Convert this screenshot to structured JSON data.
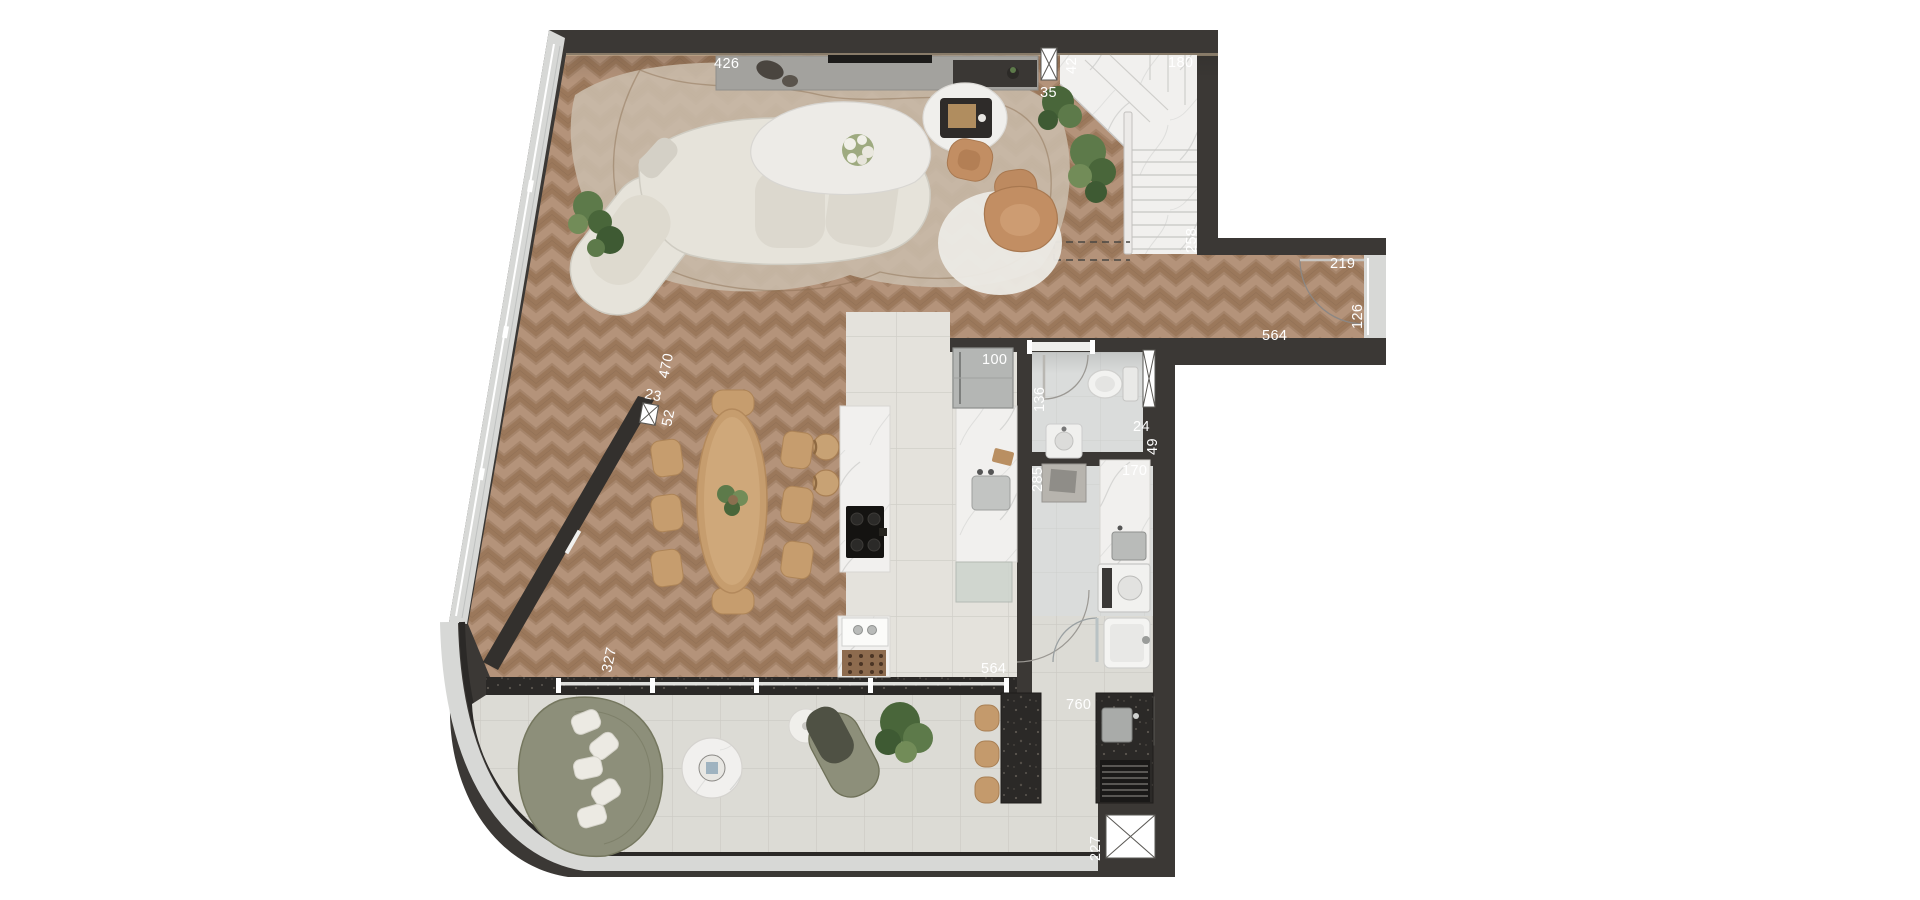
{
  "plan": {
    "type": "apartment-floor-plan-top-view",
    "labels": [
      {
        "id": "living-north-wall",
        "text": "426",
        "orientation": "horizontal"
      },
      {
        "id": "stair-door-gap",
        "text": "35",
        "orientation": "horizontal"
      },
      {
        "id": "stair-window",
        "text": "42",
        "orientation": "vertical"
      },
      {
        "id": "stair-width",
        "text": "180",
        "orientation": "horizontal"
      },
      {
        "id": "stair-depth",
        "text": "258",
        "orientation": "vertical"
      },
      {
        "id": "hallway-width",
        "text": "219",
        "orientation": "horizontal"
      },
      {
        "id": "hallway-door",
        "text": "126",
        "orientation": "vertical"
      },
      {
        "id": "hallway-length",
        "text": "564",
        "orientation": "horizontal"
      },
      {
        "id": "west-window",
        "text": "470",
        "orientation": "vertical"
      },
      {
        "id": "west-pier",
        "text": "23",
        "orientation": "horizontal"
      },
      {
        "id": "west-small-window",
        "text": "52",
        "orientation": "vertical"
      },
      {
        "id": "kitchen-counter-width",
        "text": "100",
        "orientation": "horizontal"
      },
      {
        "id": "bathroom-depth",
        "text": "136",
        "orientation": "vertical"
      },
      {
        "id": "bathroom-pier",
        "text": "24",
        "orientation": "horizontal"
      },
      {
        "id": "bathroom-shaft",
        "text": "49",
        "orientation": "vertical"
      },
      {
        "id": "laundry-depth",
        "text": "285",
        "orientation": "vertical"
      },
      {
        "id": "laundry-width",
        "text": "170",
        "orientation": "horizontal"
      },
      {
        "id": "southwest-wall",
        "text": "327",
        "orientation": "vertical"
      },
      {
        "id": "terrace-opening",
        "text": "564",
        "orientation": "horizontal"
      },
      {
        "id": "terrace-length",
        "text": "760",
        "orientation": "horizontal"
      },
      {
        "id": "shaft-width",
        "text": "227",
        "orientation": "vertical"
      }
    ],
    "rooms": [
      "living-room",
      "dining-area",
      "kitchen",
      "bathroom",
      "laundry",
      "hallway",
      "staircase",
      "terrace"
    ],
    "furniture": [
      "curved-sofa",
      "coffee-tables",
      "ottomans",
      "armchair",
      "tv-console",
      "dining-table",
      "dining-chairs",
      "kitchen-island",
      "cooktop",
      "fridge",
      "counter-sink",
      "toilet",
      "washbasin",
      "washer",
      "laundry-tub",
      "outdoor-sofa",
      "outdoor-lounger",
      "side-tables",
      "bar-counter",
      "bar-stools",
      "grill",
      "plants",
      "stair-marble"
    ],
    "colors": {
      "wall": "#3b3835",
      "wood_floor": "#a5846a",
      "kitchen_tile": "#e4e2dc",
      "terrace_tile": "#dcdbd5",
      "marble": "#f1f0ee",
      "terrazzo": "#2b2927",
      "glazing": "#d7d8d6",
      "sofa_cream": "#e6e3da",
      "leather_tan": "#c28e63",
      "wood_furniture": "#c69d6e",
      "outdoor_olive": "#8d8f7a",
      "label_text": "#ffffff"
    }
  }
}
